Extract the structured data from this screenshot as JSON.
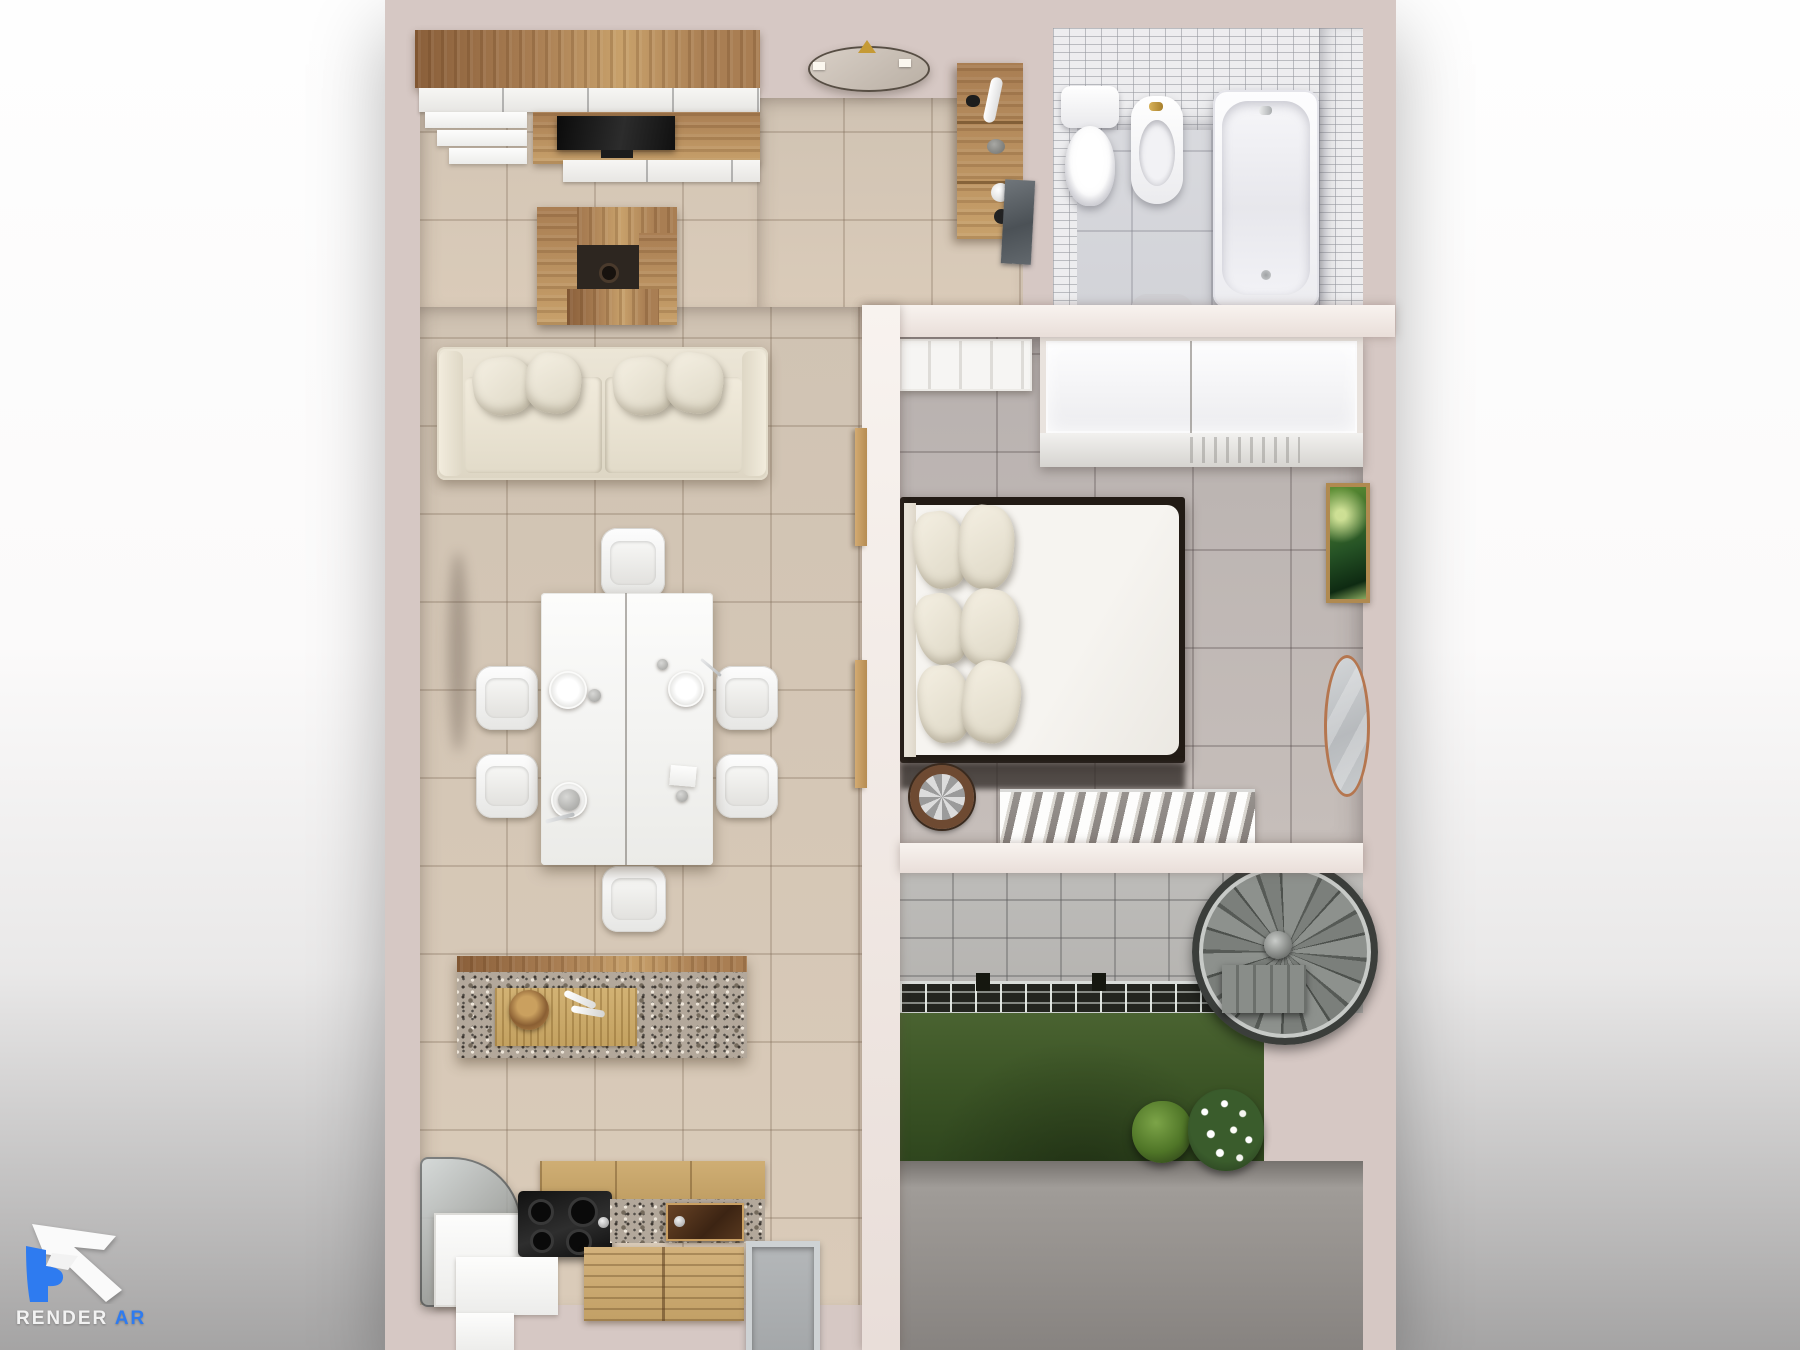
{
  "logo": {
    "brand": "RENDER",
    "suffix": "AR"
  },
  "scene": {
    "type": "photorealistic top-down 3d floor plan render",
    "rooms": [
      {
        "name": "living-room",
        "items": [
          "tv-wall-unit",
          "flat-tv",
          "wall-cube-shelf",
          "sofa",
          "throw-pillows",
          "dining-table",
          "dining-chairs",
          "plates-and-cups",
          "kitchen-island",
          "bamboo-placemat",
          "wooden-bowl",
          "serving-spoons",
          "wall-wood-panels"
        ]
      },
      {
        "name": "kitchen",
        "items": [
          "glass-counter",
          "fridge-cabinet",
          "gas-cooktop",
          "granite-counter",
          "oven-glass-door",
          "wood-crate",
          "white-floor-mat",
          "metal-drain-tray"
        ]
      },
      {
        "name": "hallway",
        "items": [
          "ceiling-lamp",
          "storage-shelf",
          "bathroom-glass-door"
        ]
      },
      {
        "name": "bathroom",
        "items": [
          "toilet",
          "bidet",
          "bathtub",
          "bath-mat",
          "mosaic-wall"
        ]
      },
      {
        "name": "bedroom",
        "items": [
          "panel-door",
          "wardrobe-closet",
          "double-bed",
          "pillows",
          "bedside-fan-table",
          "laundry-drying-rack",
          "wall-art",
          "oval-mirror"
        ]
      },
      {
        "name": "terrace",
        "items": [
          "stone-tile-wall",
          "metal-floor-grate",
          "green-living-wall",
          "moss-ball-plant",
          "white-flower-bush",
          "spiral-staircase",
          "concrete-floor"
        ]
      }
    ]
  },
  "colors": {
    "bg_top": "#fefefe",
    "bg_bottom": "#a5a4a4",
    "wall": "#d6c8c4",
    "wall_bright": "#f6f0ec",
    "floor_living_a": "#d0c3b3",
    "floor_living_b": "#dacbb9",
    "floor_bedroom": "#b8b1af",
    "floor_bath": "#dcdde1",
    "mosaic": "#ededef",
    "stone": "#b4b2af",
    "green_wall": "#4a6331",
    "green_deep": "#2e451d",
    "concrete": "#a09c98",
    "concrete_dark": "#878380",
    "wood": "#a97e53",
    "wood_light": "#c8a16b",
    "wood_deep": "#8a5f3a",
    "granite": "#b3a89b",
    "grate_dark": "#23251f",
    "gold": "#c59a35",
    "mirror_rim": "#b5764f",
    "logo_blue": "#2e7bf0"
  }
}
